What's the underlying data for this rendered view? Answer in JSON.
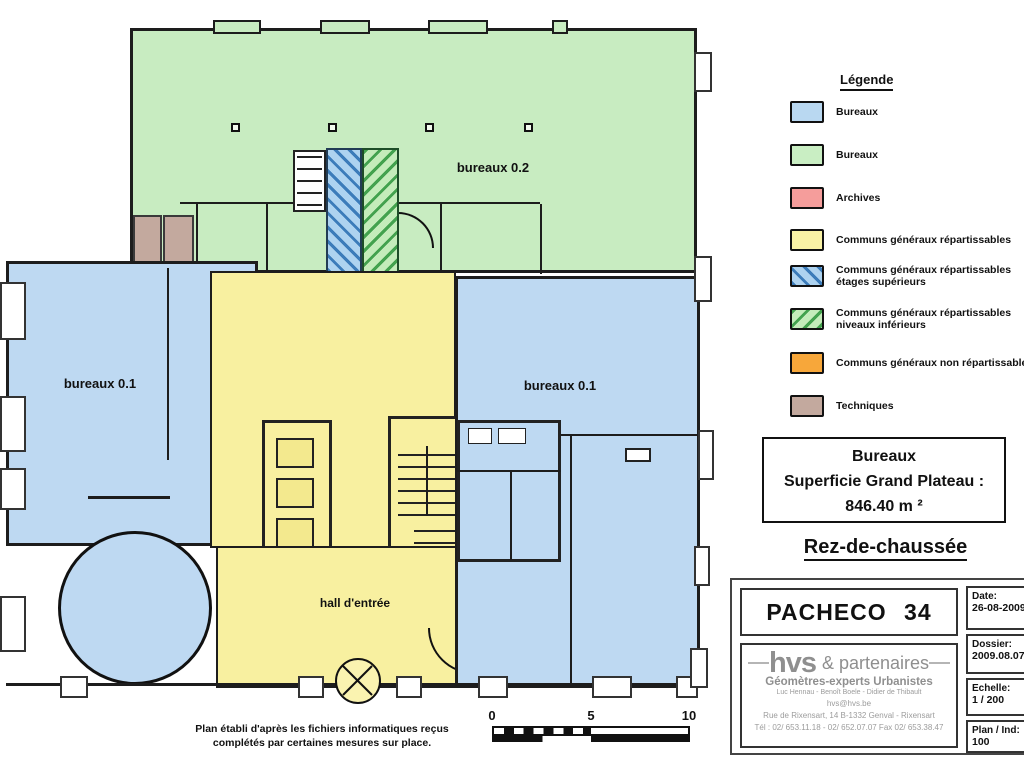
{
  "plan": {
    "labels": {
      "bureaux_02": "bureaux 0.2",
      "bureaux_01_left": "bureaux 0.1",
      "bureaux_01_right": "bureaux 0.1",
      "hall": "hall d'entrée"
    },
    "colors": {
      "bureaux_blue": "#bed9f2",
      "bureaux_green": "#c8ecc1",
      "communs_yellow": "#f8f0a0",
      "techniques_brown": "#c3a99e"
    }
  },
  "legend": {
    "title": "Légende",
    "items": [
      {
        "name": "bureaux-blue",
        "label": "Bureaux",
        "color": "#b9d8f1"
      },
      {
        "name": "bureaux-green",
        "label": "Bureaux",
        "color": "#c9eec3"
      },
      {
        "name": "archives",
        "label": "Archives",
        "color": "#f59d9b"
      },
      {
        "name": "communs-repartissables",
        "label": "Communs généraux répartissables",
        "color": "#f9f2a5"
      },
      {
        "name": "communs-etages-superieurs",
        "label": "Communs généraux répartissables",
        "label2": "étages supérieurs",
        "base_color": "#aed3f0",
        "stripe_color": "#3c7cba"
      },
      {
        "name": "communs-niveaux-inferieurs",
        "label": "Communs généraux répartissables",
        "label2": "niveaux inférieurs",
        "base_color": "#c4ecba",
        "stripe_color": "#43a24e"
      },
      {
        "name": "communs-non-repartissables",
        "label": "Communs généraux non répartissables",
        "color": "#f7a73a"
      },
      {
        "name": "techniques",
        "label": "Techniques",
        "color": "#c3a99e"
      }
    ]
  },
  "summary_box": {
    "line1": "Bureaux",
    "line2": "Superficie Grand Plateau :",
    "line3": "846.40 m ²"
  },
  "floor_title": "Rez-de-chaussée",
  "title_block": {
    "project": "PACHECO 34",
    "company": {
      "logo_bold": "hvs",
      "logo_rest": "& partenaires",
      "subtitle": "Géomètres-experts Urbanistes",
      "partners": "Luc Hennau - Benoît Boele - Didier de Thibault",
      "email": "hvs@hvs.be",
      "address": "Rue de Rixensart, 14      B-1332 Genval - Rixensart",
      "phone": "Tél : 02/ 653.11.18 - 02/ 652.07.07      Fax 02/ 653.38.47"
    },
    "fields": [
      {
        "label": "Date:",
        "value": "26-08-2009"
      },
      {
        "label": "Dossier:",
        "value": "2009.08.07"
      },
      {
        "label": "Echelle:",
        "value": "1 / 200"
      },
      {
        "label": "Plan / Ind:",
        "value": "100"
      }
    ]
  },
  "footnote": {
    "line1": "Plan établi d'après les fichiers informatiques reçus",
    "line2": "complétés par certaines mesures sur place."
  },
  "scale_bar": {
    "ticks": [
      "0",
      "5",
      "10"
    ]
  }
}
